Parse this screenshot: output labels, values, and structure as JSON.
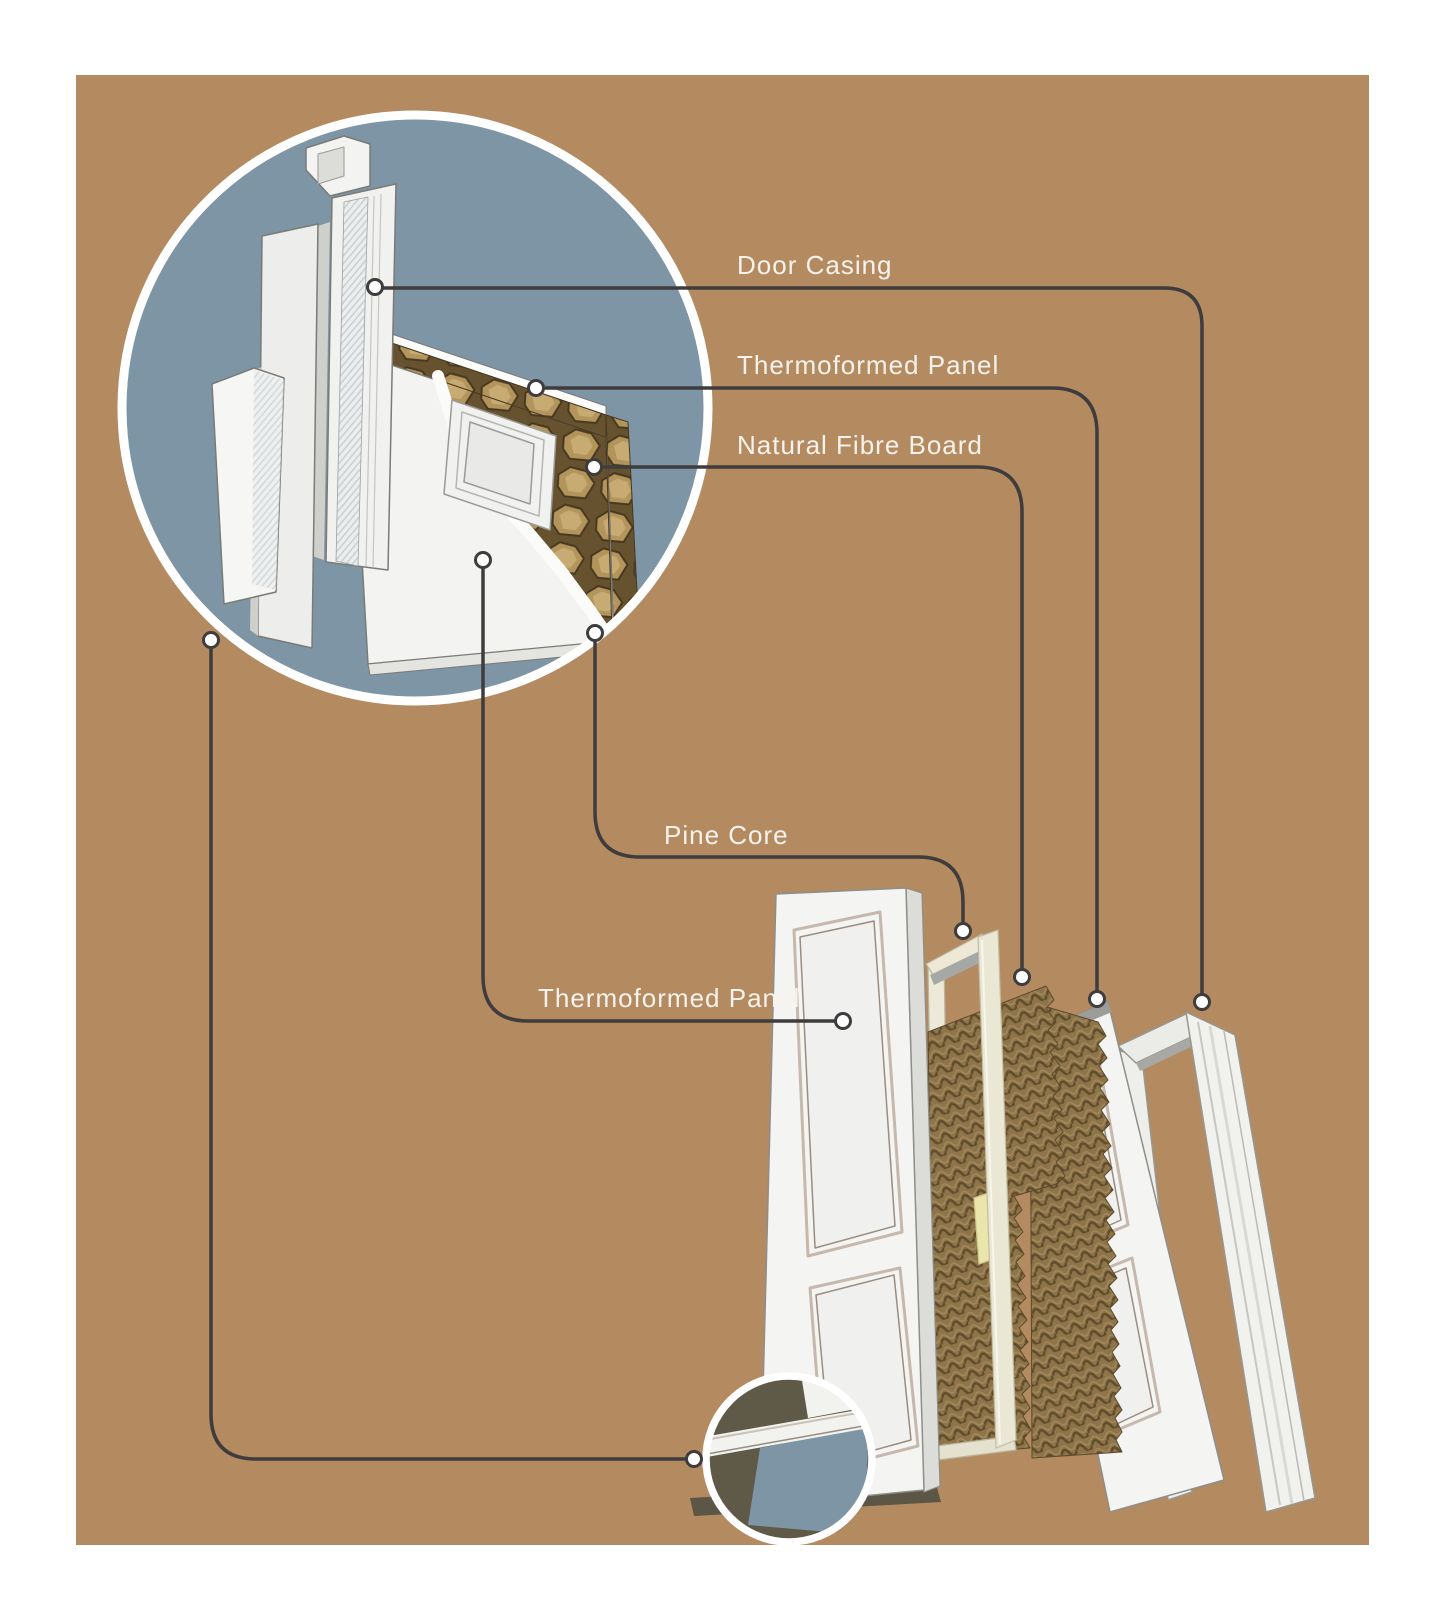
{
  "diagram_title": "Door construction exploded diagram",
  "callouts": [
    {
      "id": "door-casing",
      "label": "Door Casing"
    },
    {
      "id": "thermoformed-panel-top",
      "label": "Thermoformed Panel"
    },
    {
      "id": "natural-fibre-board",
      "label": "Natural Fibre Board"
    },
    {
      "id": "pine-core",
      "label": "Pine Core"
    },
    {
      "id": "thermoformed-panel-bottom",
      "label": "Thermoformed Panel"
    }
  ],
  "colors": {
    "page_margin": "#ffffff",
    "backdrop_panel": "#b48a60",
    "detail_circle_fill": "#7e95a5",
    "detail_circle_ring": "#ffffff",
    "connector_line": "#3e3c3c",
    "connector_dot_fill": "#ffffff",
    "label_text": "#f7f3ec",
    "corner_detail_olive": "#5f5947",
    "fibre_board": "#8d7449",
    "pine_wood": "#eae7d5",
    "door_white": "#f4f4f2"
  }
}
